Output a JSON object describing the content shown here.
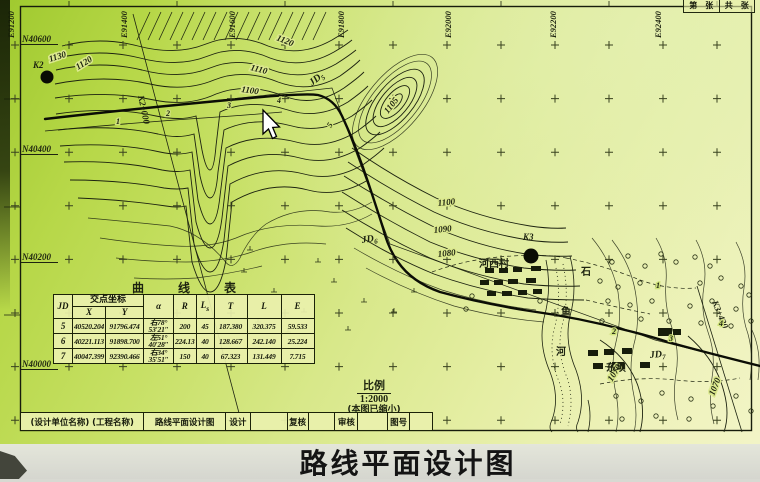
{
  "page_title": "路线平面设计图",
  "sheet_box": {
    "left": "第　张",
    "right": "共　张"
  },
  "scale_note": {
    "label": "比例",
    "value": "1:2000",
    "note": "(本图已缩小)"
  },
  "title_block": {
    "cells": [
      {
        "t": "(设计单位名称) (工程名称)",
        "w": 123
      },
      {
        "t": "路线平面设计图",
        "w": 82
      },
      {
        "t": "设计",
        "w": 25
      },
      {
        "t": "",
        "w": 37
      },
      {
        "t": "复核",
        "w": 21
      },
      {
        "t": "",
        "w": 27
      },
      {
        "t": "审核",
        "w": 23
      },
      {
        "t": "",
        "w": 30
      },
      {
        "t": "图号",
        "w": 22
      },
      {
        "t": "",
        "w": 23
      }
    ]
  },
  "curve_table": {
    "title": "曲线表",
    "headers": {
      "jd": "JD",
      "coord": "交点坐标",
      "x": "X",
      "y": "Y",
      "alpha": "α",
      "r": "R",
      "ls_main": "L",
      "ls_sub": "s",
      "t": "T",
      "l": "L",
      "e": "E"
    },
    "rows": [
      {
        "jd": "5",
        "x": "40520.204",
        "y": "91796.474",
        "a1": "右78°",
        "a2": "53′21″",
        "r": "200",
        "ls": "45",
        "t": "187.380",
        "l": "320.375",
        "e": "59.533"
      },
      {
        "jd": "6",
        "x": "40221.113",
        "y": "91898.700",
        "a1": "左51°",
        "a2": "40′28″",
        "r": "224.13",
        "ls": "40",
        "t": "128.667",
        "l": "242.140",
        "e": "25.224"
      },
      {
        "jd": "7",
        "x": "40047.399",
        "y": "92390.466",
        "a1": "右34°",
        "a2": "35′51″",
        "r": "150",
        "ls": "40",
        "t": "67.323",
        "l": "131.449",
        "e": "7.715"
      }
    ]
  },
  "grid": {
    "e_labels": [
      {
        "t": "E91200",
        "x": 10
      },
      {
        "t": "E91400",
        "x": 123
      },
      {
        "t": "E91600",
        "x": 231
      },
      {
        "t": "E91800",
        "x": 340
      },
      {
        "t": "E92000",
        "x": 447
      },
      {
        "t": "E92200",
        "x": 552
      },
      {
        "t": "E92400",
        "x": 657
      }
    ],
    "n_labels": [
      {
        "t": "N40600",
        "y": 42
      },
      {
        "t": "N40400",
        "y": 152
      },
      {
        "t": "N40200",
        "y": 260
      },
      {
        "t": "N40000",
        "y": 367
      }
    ],
    "cross": {
      "x0": 15,
      "dx": 54,
      "nx": 14,
      "y0": 45,
      "dy": 53.6,
      "ny": 8
    }
  },
  "map_labels": [
    {
      "t": "K2",
      "x": 33,
      "y": 68,
      "fs": 10,
      "cls": "pt"
    },
    {
      "t": "K3",
      "x": 523,
      "y": 240,
      "fs": 10,
      "cls": "pt"
    },
    {
      "t": "K2+000",
      "x": 138,
      "y": 96,
      "rot": 78,
      "cls": "pt"
    },
    {
      "t": "K3+430",
      "x": 712,
      "y": 302,
      "rot": 68,
      "cls": "pt"
    },
    {
      "t": "JD",
      "sub": "5",
      "x": 312,
      "y": 86,
      "rot": -38,
      "cls": "jd"
    },
    {
      "t": "JD",
      "sub": "6",
      "x": 362,
      "y": 243,
      "rot": -8,
      "cls": "jd"
    },
    {
      "t": "JD",
      "sub": "7",
      "x": 650,
      "y": 358,
      "rot": -5,
      "cls": "jd"
    },
    {
      "t": "1130",
      "x": 50,
      "y": 62,
      "rot": -18,
      "cls": "ct"
    },
    {
      "t": "1120",
      "x": 78,
      "y": 70,
      "rot": -32,
      "cls": "ct"
    },
    {
      "t": "1120",
      "x": 276,
      "y": 40,
      "rot": 22,
      "cls": "ct"
    },
    {
      "t": "1110",
      "x": 250,
      "y": 70,
      "rot": 14,
      "cls": "ct"
    },
    {
      "t": "1100",
      "x": 241,
      "y": 92,
      "rot": 8,
      "cls": "ct"
    },
    {
      "t": "1105",
      "x": 388,
      "y": 114,
      "rot": -52,
      "cls": "ct"
    },
    {
      "t": "1100",
      "x": 438,
      "y": 206,
      "rot": -6,
      "cls": "ct"
    },
    {
      "t": "1090",
      "x": 434,
      "y": 233,
      "rot": -6,
      "cls": "ct"
    },
    {
      "t": "1080",
      "x": 438,
      "y": 257,
      "rot": -6,
      "cls": "ct"
    },
    {
      "t": "1070",
      "x": 612,
      "y": 382,
      "rot": -58,
      "cls": "ct"
    },
    {
      "t": "1070",
      "x": 714,
      "y": 396,
      "rot": -68,
      "cls": "ct"
    },
    {
      "t": "河西村",
      "x": 479,
      "y": 267,
      "cls": "pl"
    },
    {
      "t": "东坝",
      "x": 606,
      "y": 371,
      "cls": "pl"
    },
    {
      "t": "石",
      "x": 581,
      "y": 275,
      "cls": "pl"
    },
    {
      "t": "鱼",
      "x": 561,
      "y": 315,
      "cls": "pl"
    },
    {
      "t": "河",
      "x": 556,
      "y": 355,
      "cls": "pl"
    },
    {
      "t": "1",
      "x": 116,
      "y": 124,
      "cls": "st"
    },
    {
      "t": "2",
      "x": 166,
      "y": 116,
      "cls": "st"
    },
    {
      "t": "3",
      "x": 227,
      "y": 108,
      "cls": "st"
    },
    {
      "t": "4",
      "x": 277,
      "y": 103,
      "cls": "st"
    },
    {
      "t": "5",
      "x": 331,
      "y": 128,
      "rot": -60,
      "cls": "st"
    },
    {
      "t": "1",
      "x": 656,
      "y": 288,
      "cls": "st"
    },
    {
      "t": "2",
      "x": 612,
      "y": 334,
      "cls": "st"
    },
    {
      "t": "3",
      "x": 669,
      "y": 341,
      "cls": "st"
    },
    {
      "t": "4",
      "x": 719,
      "y": 326,
      "cls": "st"
    }
  ],
  "symbols": {
    "benchmarks": [
      {
        "x": 47,
        "y": 77,
        "r": 6.5
      },
      {
        "x": 531,
        "y": 256,
        "r": 7.5
      }
    ],
    "buildings": [
      [
        485,
        268,
        9,
        5
      ],
      [
        499,
        268,
        9,
        5
      ],
      [
        513,
        267,
        9,
        5
      ],
      [
        531,
        266,
        10,
        5
      ],
      [
        480,
        280,
        9,
        5
      ],
      [
        494,
        280,
        9,
        5
      ],
      [
        508,
        279,
        10,
        5
      ],
      [
        526,
        278,
        10,
        5
      ],
      [
        487,
        291,
        9,
        5
      ],
      [
        502,
        291,
        10,
        5
      ],
      [
        518,
        290,
        9,
        5
      ],
      [
        533,
        289,
        9,
        5
      ],
      [
        588,
        350,
        10,
        6
      ],
      [
        604,
        349,
        10,
        6
      ],
      [
        622,
        348,
        10,
        6
      ],
      [
        593,
        363,
        10,
        6
      ],
      [
        612,
        362,
        12,
        7
      ],
      [
        658,
        328,
        14,
        8
      ],
      [
        673,
        329,
        8,
        6
      ],
      [
        640,
        362,
        10,
        6
      ]
    ],
    "trees": [
      [
        612,
        262
      ],
      [
        628,
        256
      ],
      [
        645,
        266
      ],
      [
        661,
        254
      ],
      [
        676,
        262
      ],
      [
        695,
        257
      ],
      [
        710,
        266
      ],
      [
        600,
        281
      ],
      [
        618,
        287
      ],
      [
        640,
        283
      ],
      [
        658,
        286
      ],
      [
        700,
        283
      ],
      [
        721,
        278
      ],
      [
        741,
        286
      ],
      [
        608,
        301
      ],
      [
        630,
        305
      ],
      [
        652,
        301
      ],
      [
        690,
        306
      ],
      [
        712,
        301
      ],
      [
        736,
        309
      ],
      [
        749,
        295
      ],
      [
        602,
        321
      ],
      [
        641,
        319
      ],
      [
        669,
        321
      ],
      [
        701,
        323
      ],
      [
        731,
        326
      ],
      [
        751,
        321
      ],
      [
        616,
        396
      ],
      [
        641,
        401
      ],
      [
        662,
        393
      ],
      [
        691,
        399
      ],
      [
        713,
        406
      ],
      [
        736,
        396
      ],
      [
        751,
        411
      ],
      [
        622,
        419
      ],
      [
        656,
        416
      ],
      [
        689,
        419
      ],
      [
        472,
        296
      ],
      [
        466,
        309
      ],
      [
        540,
        301
      ]
    ],
    "paddy": [
      [
        244,
        272
      ],
      [
        274,
        292
      ],
      [
        304,
        312
      ],
      [
        334,
        282
      ],
      [
        364,
        302
      ],
      [
        258,
        322
      ],
      [
        288,
        332
      ],
      [
        394,
        312
      ],
      [
        414,
        292
      ],
      [
        318,
        262
      ],
      [
        348,
        330
      ],
      [
        250,
        250
      ]
    ],
    "hatch": {
      "x0": 150,
      "step": 11,
      "n": 17,
      "y1": 12,
      "y2": 40,
      "slant": -13
    }
  },
  "colors": {
    "paper_dark": "#a9cf37",
    "paper_mid": "#d9e78c",
    "paper_light": "#f1f3c4",
    "ink": "#1d2310",
    "route": "#0b0d05",
    "strip_bg": "#d8d9d2",
    "title_color": "#141414"
  }
}
